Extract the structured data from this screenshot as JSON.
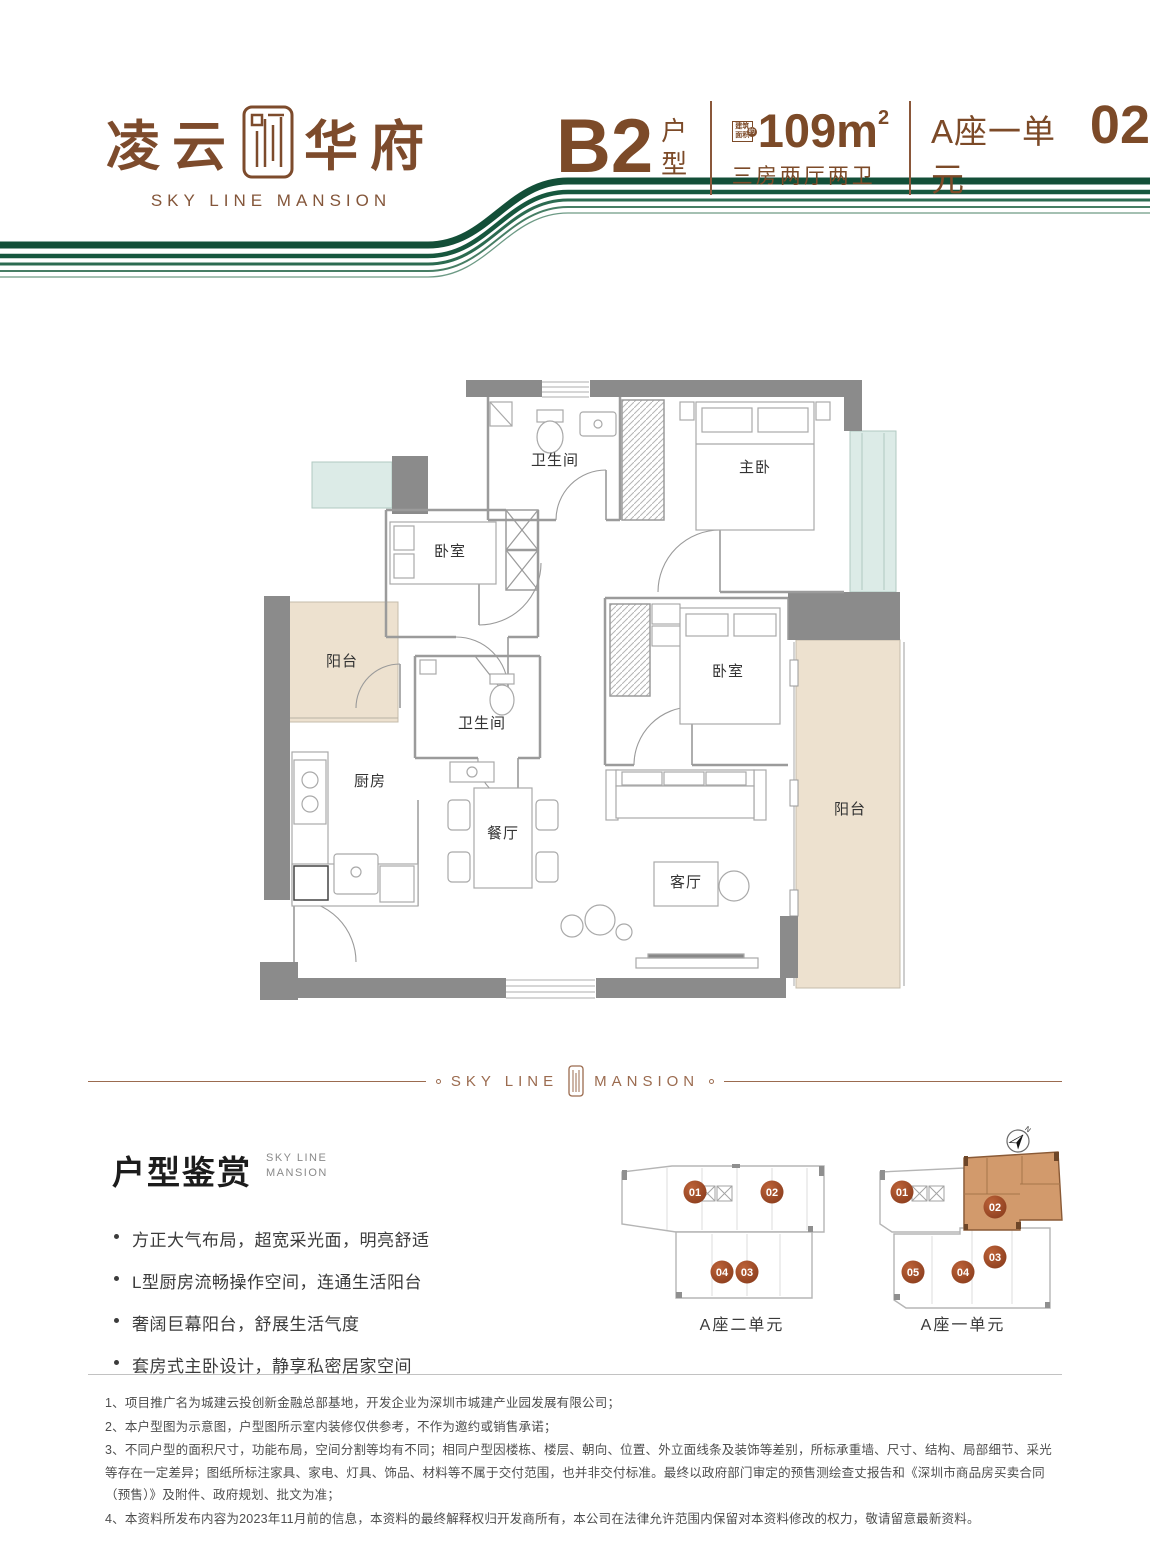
{
  "brand": {
    "logo_cn_left": "凌云",
    "logo_cn_right": "华府",
    "logo_en": "SKY LINE MANSION"
  },
  "header": {
    "unit_code": "B2",
    "unit_type": "户型",
    "area_badge_text": "建筑面积",
    "area_badge_approx": "约",
    "area_value": "109m",
    "area_sup": "2",
    "layout_desc": "三房两厅两卫",
    "location_prefix": "A座一单元",
    "location_number": "02"
  },
  "floorplan": {
    "rooms": [
      "卫生间",
      "主卧",
      "卧室",
      "卧室",
      "卫生间",
      "阳台",
      "厨房",
      "餐厅",
      "客厅",
      "阳台"
    ]
  },
  "section_divider": {
    "left": "SKY LINE",
    "right": "MANSION"
  },
  "features": {
    "title": "户型鉴赏",
    "subtitle_line1": "SKY LINE",
    "subtitle_line2": "MANSION",
    "items": [
      "方正大气布局，超宽采光面，明亮舒适",
      "L型厨房流畅操作空间，连通生活阳台",
      "奢阔巨幕阳台，舒展生活气度",
      "套房式主卧设计，静享私密居家空间"
    ]
  },
  "keyplan": {
    "compass": "N",
    "buildings": [
      {
        "label": "A座二单元",
        "units": [
          "01",
          "02",
          "04",
          "03"
        ]
      },
      {
        "label": "A座一单元",
        "units": [
          "01",
          "02",
          "05",
          "04",
          "03"
        ]
      }
    ]
  },
  "disclaimer": [
    "1、项目推广名为城建云投创新金融总部基地，开发企业为深圳市城建产业园发展有限公司；",
    "2、本户型图为示意图，户型图所示室内装修仅供参考，不作为邀约或销售承诺；",
    "3、不同户型的面积尺寸，功能布局，空间分割等均有不同；相同户型因楼栋、楼层、朝向、位置、外立面线条及装饰等差别，所标承重墙、尺寸、结构、局部细节、采光等存在一定差异；图纸所标注家具、家电、灯具、饰品、材料等不属于交付范围，也并非交付标准。最终以政府部门审定的预售测绘查丈报告和《深圳市商品房买卖合同（预售）》及附件、政府规划、批文为准；",
    "4、本资料所发布内容为2023年11月前的信息，本资料的最终解释权归开发商所有，本公司在法律允许范围内保留对本资料修改的权力，敬请留意最新资料。"
  ],
  "colors": {
    "brand_brown": "#7c4a28",
    "ribbon_green": "#15543c",
    "highlight_tan": "#d29a6c",
    "badge_rust": "#9a4a26",
    "wall_gray": "#8b8b8b",
    "balcony_beige": "#ede1cf",
    "glass_teal": "#dcebe7"
  }
}
